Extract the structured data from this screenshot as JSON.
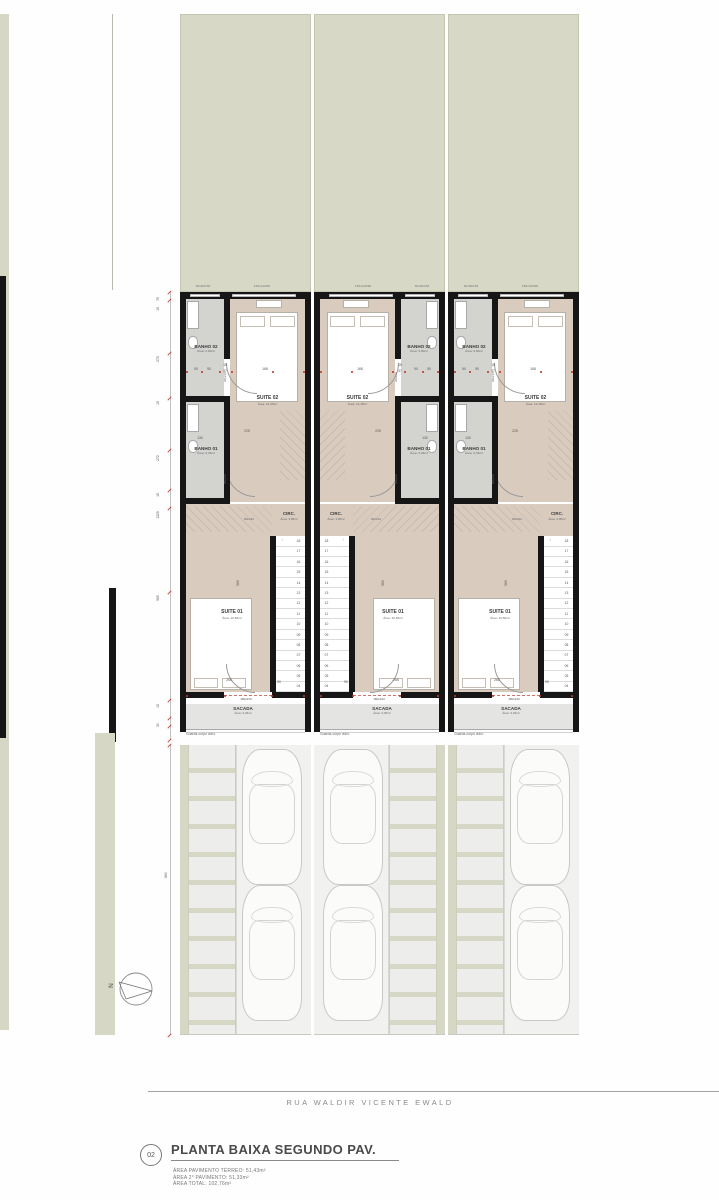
{
  "sheet": {
    "street_name": "RUA WALDIR VICENTE EWALD"
  },
  "title_block": {
    "number": "02",
    "title": "PLANTA BAIXA SEGUNDO PAV.",
    "area_lines": [
      "ÁREA PAVIMENTO TÉRREO: 51,43m²",
      "ÁREA 2° PAVIMENTO: 51,33m²",
      "ÁREA TOTAL: 102,76m²"
    ]
  },
  "north": {
    "label": "N"
  },
  "rooms": {
    "banho02": {
      "name": "BANHO 02",
      "area": "Área: 3,00m²"
    },
    "suite02": {
      "name": "SUITE 02",
      "area": "Área: 12,45m²"
    },
    "banho01": {
      "name": "BANHO 01",
      "area": "Área: 3,34m²"
    },
    "circ": {
      "name": "CIRC.",
      "area": "Área: 3,05m²"
    },
    "suite01": {
      "name": "SUITE 01",
      "area": "Área: 10,50m²"
    },
    "sacada": {
      "name": "SACADA"
    }
  },
  "units": [
    {
      "id": "unit-1",
      "mirrored": false,
      "sacada_area": "Área: 3,33m²"
    },
    {
      "id": "unit-2",
      "mirrored": true,
      "sacada_area": "Área: 3,45m²"
    },
    {
      "id": "unit-3",
      "mirrored": false,
      "sacada_area": "Área: 3,33m²"
    }
  ],
  "labels": {
    "guard_rail": "Guarda-corpo vidro",
    "window_small": "60x60/150",
    "window_large": "150x120/90",
    "door_banho02": "90x210",
    "door_banho01": "80x210",
    "door_circ": "80x210",
    "door_sacada": "180x210"
  },
  "stairs": {
    "numbers": [
      "18",
      "17",
      "16",
      "15",
      "14",
      "13",
      "12",
      "11",
      "10",
      "09",
      "08",
      "07",
      "06",
      "05",
      "04"
    ]
  },
  "dimensions": {
    "left_chain": [
      "75",
      "15",
      "273",
      "15",
      "272",
      "15",
      "1325",
      "565",
      "15",
      "30"
    ],
    "driveway_depth": "660",
    "interior": [
      "50",
      "90",
      "15",
      "37",
      "168",
      "130",
      "225",
      "265",
      "90",
      "565"
    ]
  },
  "colors": {
    "wall": "#161616",
    "backyard": "#d7d8c5",
    "wood_floor": "#d9ccbf",
    "tile_floor": "#d3d3d0",
    "balcony": "#e4e4e2",
    "paver": "#ededeb",
    "lot_strip": "#d6d7c4",
    "dimension_red": "#c0392b"
  }
}
